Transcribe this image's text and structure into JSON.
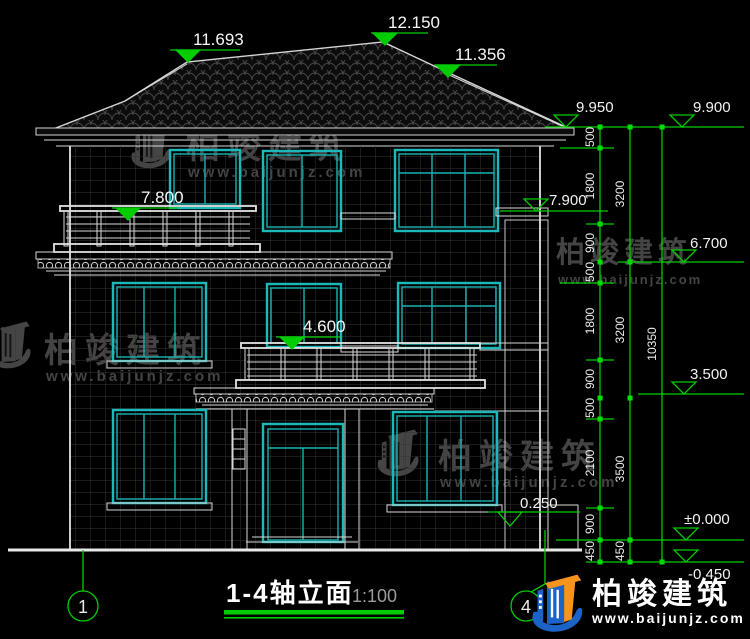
{
  "title": {
    "text": "1-4轴立面",
    "scale": "1:100"
  },
  "axes": {
    "left": "1",
    "right": "4"
  },
  "markers": {
    "ridge_left": "11.693",
    "ridge_peak": "12.150",
    "ridge_right": "11.356",
    "eave_right": "9.950",
    "parapet_right": "9.900",
    "balcony_3f": "7.800",
    "ledge_3f": "7.900",
    "level_6700": "6.700",
    "balcony_2f": "4.600",
    "porch_roof": "3.500",
    "plinth": "0.250",
    "ground": "±0.000",
    "site": "-0.450"
  },
  "dims": {
    "col1": [
      "500",
      "1800",
      "900",
      "500",
      "1800",
      "900",
      "500",
      "2100",
      "900",
      "450"
    ],
    "col2": [
      "3200",
      "3200",
      "3500",
      "450"
    ],
    "col3": [
      "10350"
    ]
  },
  "watermark": {
    "brand": "柏竣建筑",
    "url": "www.baijunjz.com"
  },
  "colors": {
    "dim_green": "#00cc00",
    "window_cyan": "#1bb9b9",
    "line_white": "#d8d8d8",
    "logo_blue": "#1c63c8",
    "logo_orange": "#f7941d"
  }
}
